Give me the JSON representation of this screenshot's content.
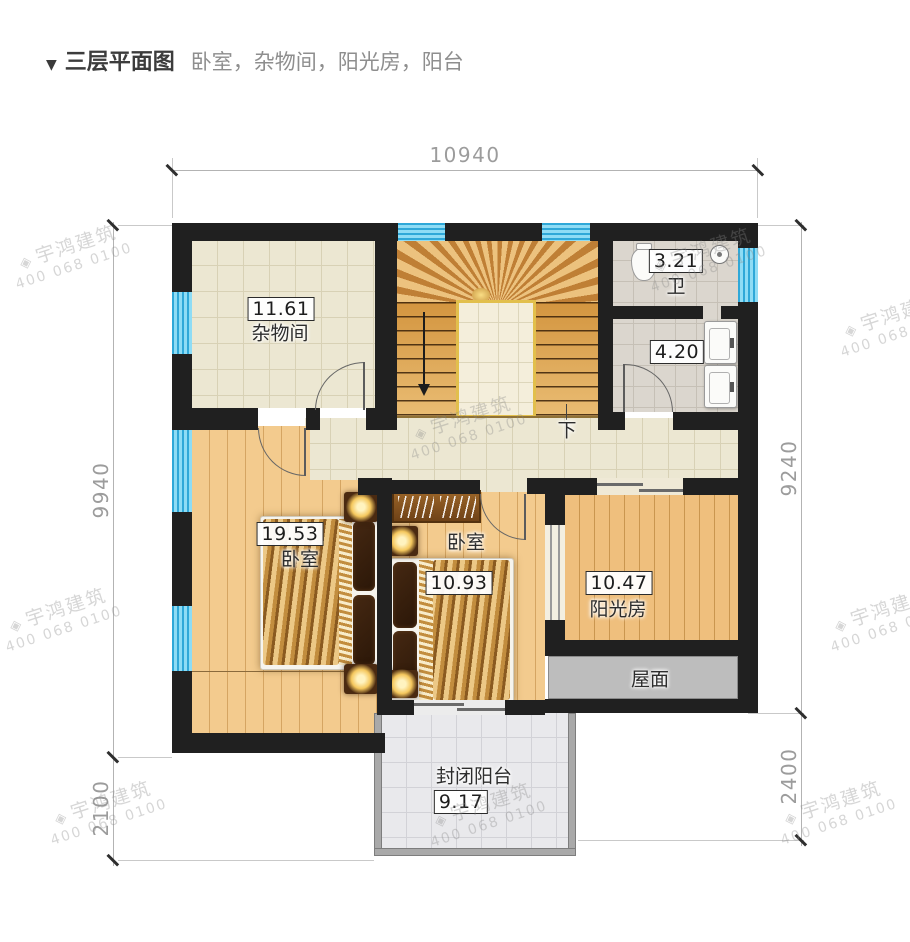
{
  "title": {
    "marker": "▼",
    "heading": "三层平面图",
    "subtitle": "卧室，杂物间，阳光房，阳台"
  },
  "watermark": {
    "brand": "宇鸿建筑",
    "phone": "400 068 0100"
  },
  "dimensions": {
    "top": "10940",
    "left_upper": "9940",
    "left_lower": "2100",
    "right_upper": "9240",
    "right_lower": "2400"
  },
  "rooms": {
    "storage": {
      "area": "11.61",
      "name": "杂物间"
    },
    "bathroom": {
      "area": "3.21",
      "name": "卫"
    },
    "washroom": {
      "area": "4.20"
    },
    "bedroom_left": {
      "area": "19.53",
      "name": "卧室"
    },
    "bedroom_mid": {
      "area": "10.93",
      "name": "卧室"
    },
    "sunroom": {
      "area": "10.47",
      "name": "阳光房"
    },
    "roof": {
      "name": "屋面"
    },
    "balcony": {
      "area": "9.17",
      "name": "封闭阳台"
    }
  },
  "stairs": {
    "down_label": "下"
  }
}
